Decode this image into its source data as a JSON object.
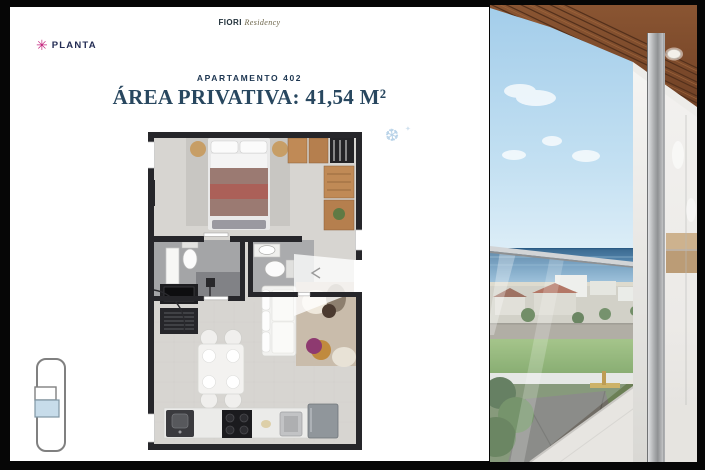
{
  "brand": {
    "name_primary": "FIORI",
    "name_secondary": "Residency"
  },
  "header": {
    "planta_icon_glyph": "✳",
    "planta_label": "PLANTA",
    "apartment_label": "APARTAMENTO 402",
    "area_title": "ÁREA PRIVATIVA: 41,54 M²"
  },
  "decor": {
    "sparkle_glyph": "❆",
    "sparkle_small_glyph": "✦"
  },
  "colors": {
    "frame_black": "#060606",
    "panel_white": "#ffffff",
    "accent_magenta": "#c4267e",
    "heading_navy": "#28475f",
    "label_navy": "#1c3550",
    "sparkle_blue": "#b9d3e8",
    "plan_wall": "#26262a",
    "plan_floor": "#d7d5d1",
    "keyplan_highlight": "#c7dcea",
    "sky_blue": "#a3cdea",
    "sea_blue": "#39688f",
    "field_green": "#6e9a49",
    "wood_ceiling": "#7b4a2e"
  }
}
